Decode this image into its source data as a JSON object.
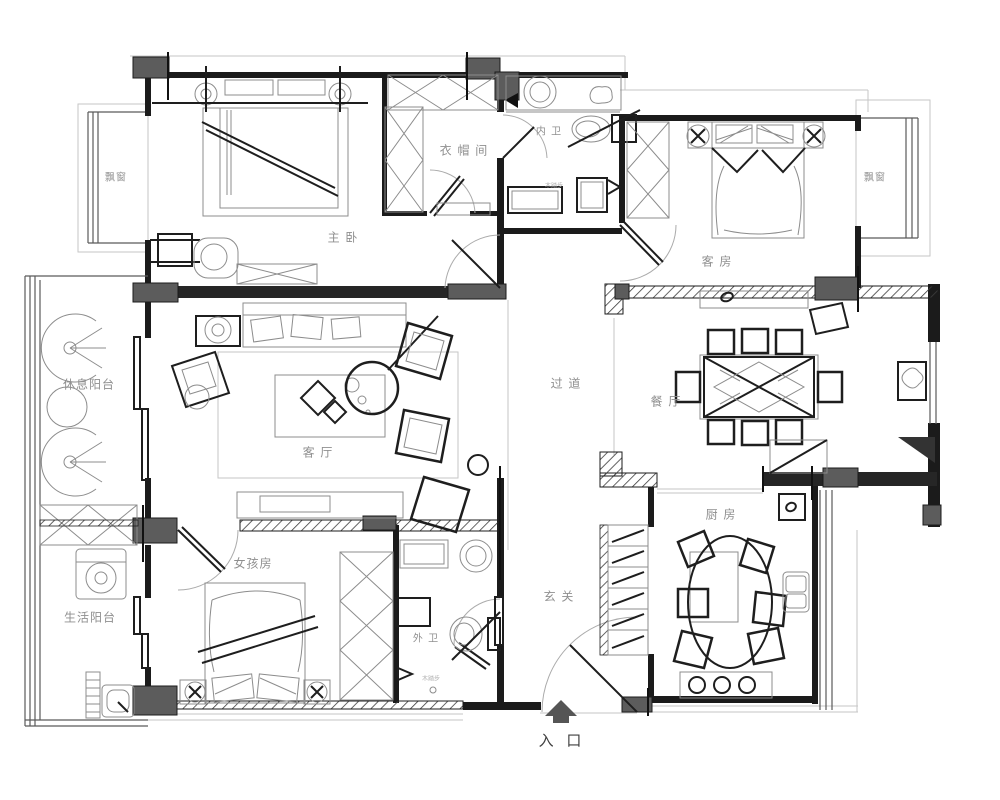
{
  "plan": {
    "title": "apartment-floor-plan",
    "rooms": [
      {
        "id": "master-bedroom",
        "label": "主 卧"
      },
      {
        "id": "closet",
        "label": "衣 帽 间"
      },
      {
        "id": "master-bath",
        "label": "内 卫"
      },
      {
        "id": "guest-room",
        "label": "客 房"
      },
      {
        "id": "living-room",
        "label": "客 厅"
      },
      {
        "id": "corridor",
        "label": "过 道"
      },
      {
        "id": "dining-room",
        "label": "餐 厅"
      },
      {
        "id": "kitchen",
        "label": "厨 房"
      },
      {
        "id": "girls-room",
        "label": "女孩房"
      },
      {
        "id": "guest-bath",
        "label": "外 卫"
      },
      {
        "id": "entry-hall",
        "label": "玄 关"
      },
      {
        "id": "rest-balcony",
        "label": "休息阳台"
      },
      {
        "id": "utility-balcony",
        "label": "生活阳台"
      }
    ],
    "windows": {
      "bay_left": "飘窗",
      "bay_right": "飘窗"
    },
    "entrance": {
      "label": "入 口"
    },
    "annotations": {
      "master_bath_note": "木踏步",
      "guest_bath_note": "木踏步"
    },
    "colors": {
      "wall": "#1b1b1b",
      "column": "#5c5c5c",
      "label": "#8f8f8f",
      "background": "#ffffff"
    }
  }
}
